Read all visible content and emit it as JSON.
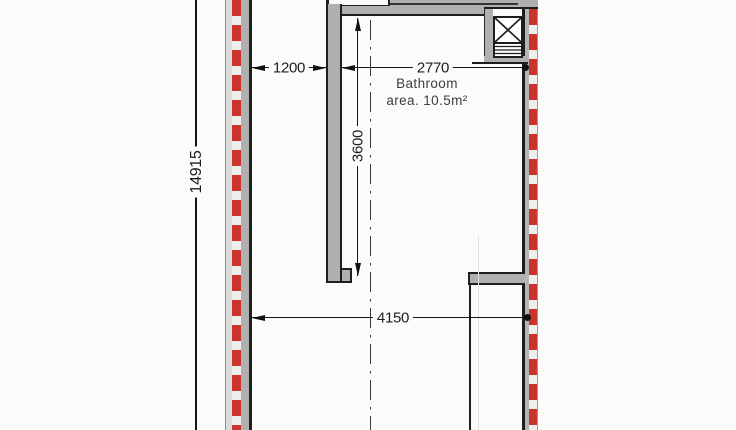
{
  "plan": {
    "type": "architectural floor plan (partial, bathroom area)",
    "room": {
      "name": "Bathroom",
      "area": "area. 10.5m²"
    },
    "dims": {
      "w1200": "1200",
      "w2770": "2770",
      "h3600": "3600",
      "w4150": "4150",
      "h14915": "14915"
    },
    "symbols": {
      "shaft_icon": "shaft-cross-icon",
      "grille_icon": "louver-grille-icon",
      "insulation_hatch": "red dashed strip along exterior walls",
      "centerline": "vertical dash-dot axis line"
    },
    "colors": {
      "background": "#fbfbfa",
      "wall_fill": "#b0b0b0",
      "outline": "#1e1e1e",
      "insulation_red": "#c9342c"
    }
  }
}
